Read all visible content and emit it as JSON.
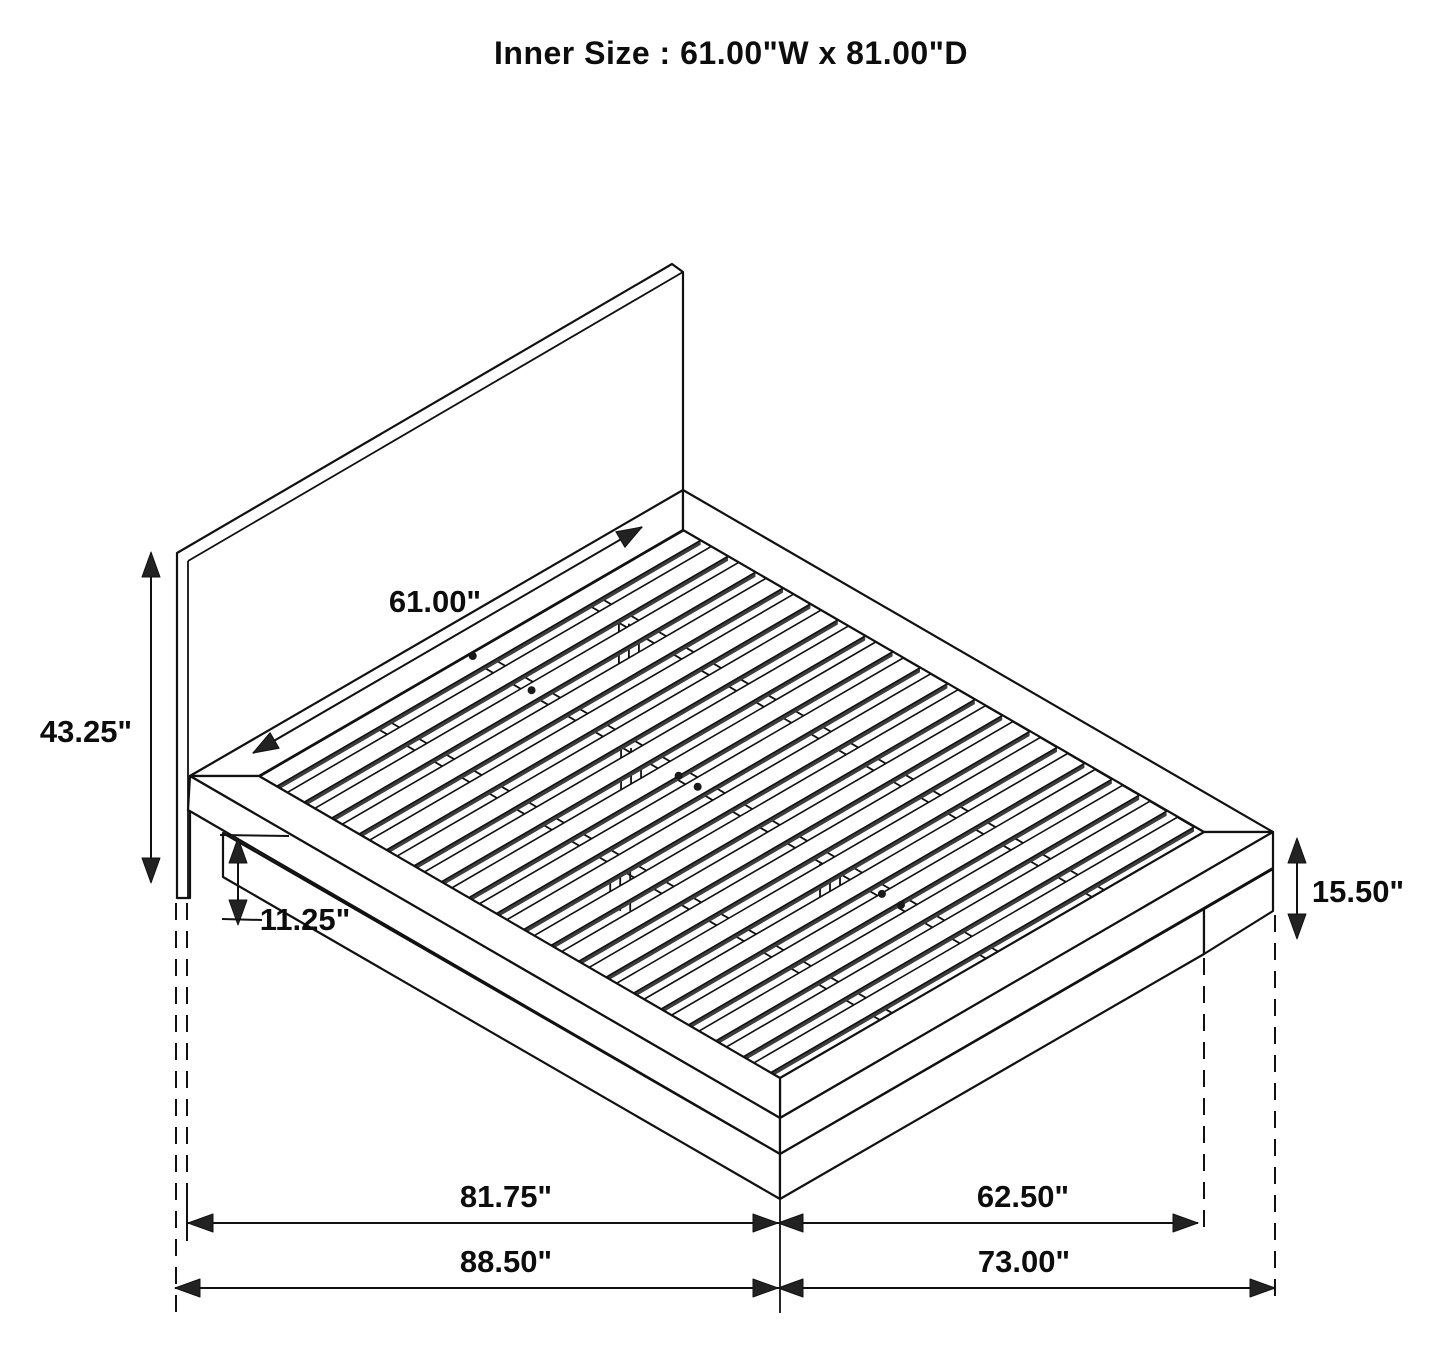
{
  "title": "Inner Size : 61.00\"W x 81.00\"D",
  "dimensions": {
    "inner_width": "61.00\"",
    "headboard_height": "43.25\"",
    "platform_bottom_clearance": "11.25\"",
    "footboard_side_height": "15.50\"",
    "platform_length": "81.75\"",
    "platform_width": "62.50\"",
    "overall_length": "88.50\"",
    "overall_width": "73.00\""
  }
}
